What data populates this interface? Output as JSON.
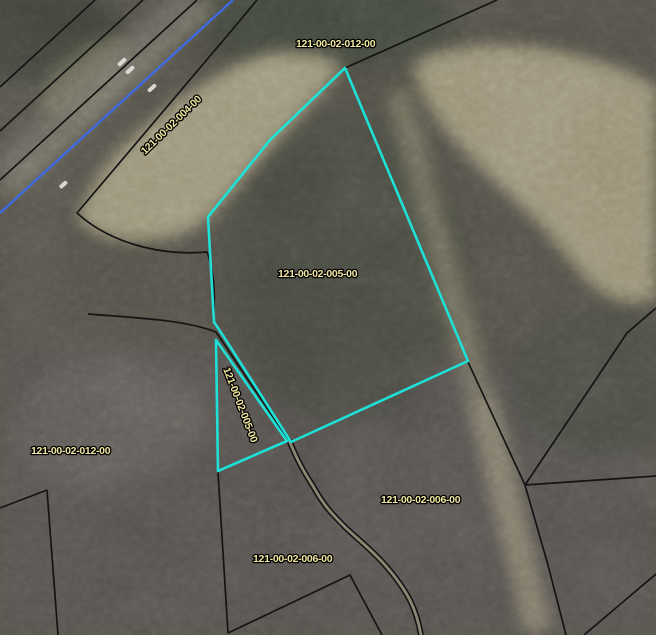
{
  "map": {
    "parcel_labels": [
      {
        "name": "parcel-012-top",
        "text": "121-00-02-012-00",
        "transform": "translate(296,47)"
      },
      {
        "name": "parcel-004",
        "text": "121-00-02-004-00",
        "transform": "translate(145,155) rotate(-44)"
      },
      {
        "name": "parcel-005-main",
        "text": "121-00-02-005-00",
        "transform": "translate(278,277)"
      },
      {
        "name": "parcel-005-sliver",
        "text": "121-00-02-005-00",
        "transform": "translate(223,369) rotate(69)"
      },
      {
        "name": "parcel-012-left",
        "text": "121-00-02-012-00",
        "transform": "translate(31,454)"
      },
      {
        "name": "parcel-006-right",
        "text": "121-00-02-006-00",
        "transform": "translate(381,503)"
      },
      {
        "name": "parcel-006-bottom",
        "text": "121-00-02-006-00",
        "transform": "translate(253,562)"
      }
    ],
    "highlight": {
      "main_parcel_points": "345,68 468,361 291,442 222,334 214,322 208,217 270,140",
      "sliver_parcel_points": "216,340 287,441 218,471"
    },
    "highway": {
      "centerline_d": "M233,0 L0,213"
    },
    "roads": {
      "s_curve_d": "M289,440 C298,462 304,472 313,486 C324,506 332,514 347,529 C367,547 377,555 391,572 C407,592 416,607 421,635"
    },
    "boundaries": [
      {
        "name": "boundary-ne",
        "d": "M345,68 L497,0"
      },
      {
        "name": "boundary-right-corner",
        "d": "M656,308 L627,333 L525,485 L656,476"
      },
      {
        "name": "boundary-right-lower",
        "d": "M468,362 L525,485 L548,565 L566,635"
      },
      {
        "name": "boundary-bottom-right-corner",
        "d": "M584,635 L656,574"
      },
      {
        "name": "boundary-bottom-left-corner",
        "d": "M47,490 L0,508 M47,490 L58,635"
      },
      {
        "name": "boundary-bottom-v",
        "d": "M218,472 L228,633 M228,633 L350,575 L382,635"
      },
      {
        "name": "highway-line-1",
        "d": "M95,0 L0,87"
      },
      {
        "name": "highway-line-2",
        "d": "M143,0 L0,131"
      },
      {
        "name": "highway-line-3",
        "d": "M197,0 L0,180"
      },
      {
        "name": "highway-field-boundary",
        "d": "M257,0 L232,30 L77,213 C110,243 160,256 207,252 C214,270 216,296 213,321"
      },
      {
        "name": "access-road-line",
        "d": "M88,314 C140,318 185,320 216,332 L288,439"
      }
    ],
    "colors": {
      "highlight": "#1fe0d6",
      "road_centerline": "#3f6ae0",
      "boundary": "#141414",
      "label_text": "#f0e69f",
      "label_outline": "#000000"
    }
  }
}
